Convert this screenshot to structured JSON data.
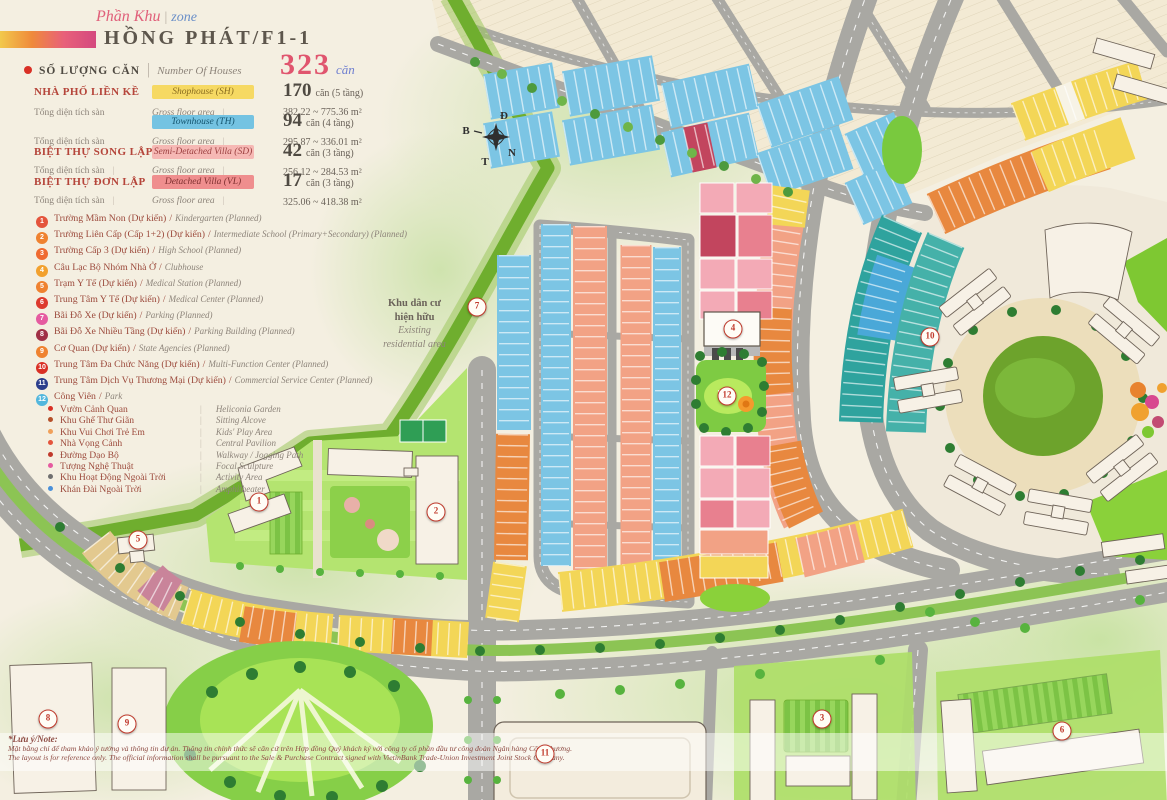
{
  "header": {
    "script_vn": "Phần Khu",
    "script_divider": "|",
    "script_en": "zone",
    "zone_name": "HỒNG PHÁT/F1-1"
  },
  "summary": {
    "label_vn": "SỐ LƯỢNG CĂN",
    "divider": "|",
    "label_en": "Number Of Houses",
    "total": "323",
    "total_unit": "căn"
  },
  "housing_table": {
    "rows": [
      {
        "name_vn": "NHÀ PHỐ LIỀN KỀ",
        "type_en": "Shophouse (SH)",
        "chip_color": "#f6d963",
        "count": "170",
        "count_suffix": "căn (5 tầng)",
        "area": "382.22 ~ 775.36 m²",
        "sub_vn": "Tổng diện tích sàn",
        "sub_en": "Gross floor area"
      },
      {
        "name_vn": "",
        "type_en": "Townhouse (TH)",
        "chip_color": "#74c3e2",
        "count": "94",
        "count_suffix": "căn (4 tầng)",
        "area": "295.87 ~ 336.01 m²",
        "sub_vn": "Tổng diện tích sàn",
        "sub_en": "Gross floor area"
      },
      {
        "name_vn": "BIỆT THỰ SONG LẬP",
        "type_en": "Semi-Detached Villa (SD)",
        "chip_color": "#f6b8b4",
        "count": "42",
        "count_suffix": "căn (3 tầng)",
        "area": "256.12 ~ 284.53 m²",
        "sub_vn": "Tổng diện tích sàn",
        "sub_en": "Gross floor area"
      },
      {
        "name_vn": "BIỆT THỰ ĐƠN LẬP",
        "type_en": "Detached Villa (VL)",
        "chip_color": "#ef8e8e",
        "count": "17",
        "count_suffix": "căn (3 tầng)",
        "area": "325.06 ~ 418.38 m²",
        "sub_vn": "Tổng diện tích sàn",
        "sub_en": "Gross floor area"
      }
    ]
  },
  "facilities": [
    {
      "num": "1",
      "vn": "Trường Mầm Non (Dự kiến)",
      "en": "Kindergarten (Planned)",
      "color": "#e4543c"
    },
    {
      "num": "2",
      "vn": "Trường Liên Cấp (Cấp 1+2) (Dự kiến)",
      "en": "Intermediate School (Primary+Secondary) (Planned)",
      "color": "#ef8230"
    },
    {
      "num": "3",
      "vn": "Trường Cấp 3 (Dự kiến)",
      "en": "High School (Planned)",
      "color": "#ef6a30"
    },
    {
      "num": "4",
      "vn": "Câu Lạc Bộ Nhóm Nhà Ở",
      "en": "Clubhouse",
      "color": "#f2a12e"
    },
    {
      "num": "5",
      "vn": "Trạm Y Tế (Dự kiến)",
      "en": "Medical Station (Planned)",
      "color": "#ef8230"
    },
    {
      "num": "6",
      "vn": "Trung Tâm Y Tế (Dự kiến)",
      "en": "Medical Center (Planned)",
      "color": "#dd3a2e"
    },
    {
      "num": "7",
      "vn": "Bãi Đỗ Xe (Dự kiến)",
      "en": "Parking (Planned)",
      "color": "#e55ba0"
    },
    {
      "num": "8",
      "vn": "Bãi Đỗ Xe Nhiều Tầng (Dự kiến)",
      "en": "Parking Building (Planned)",
      "color": "#a03046"
    },
    {
      "num": "9",
      "vn": "Cơ Quan (Dự kiến)",
      "en": "State Agencies (Planned)",
      "color": "#ef8230"
    },
    {
      "num": "10",
      "vn": "Trung Tâm Đa Chức Năng (Dự kiến)",
      "en": "Multi-Function Center (Planned)",
      "color": "#d93025"
    },
    {
      "num": "11",
      "vn": "Trung Tâm Dịch Vụ Thương Mại (Dự kiến)",
      "en": "Commercial Service Center (Planned)",
      "color": "#2c3e8c"
    },
    {
      "num": "12",
      "vn": "Công Viên",
      "en": "Park",
      "color": "#53b7dd"
    }
  ],
  "park_features": [
    {
      "vn": "Vườn Cảnh Quan",
      "en": "Heliconia Garden",
      "color": "#d93025"
    },
    {
      "vn": "Khu Ghế Thư Giãn",
      "en": "Sitting Alcove",
      "color": "#b5502a"
    },
    {
      "vn": "Khu Vui Chơi Trẻ Em",
      "en": "Kids' Play Area",
      "color": "#f0a05a"
    },
    {
      "vn": "Nhà Vọng Cảnh",
      "en": "Central Pavilion",
      "color": "#e4543c"
    },
    {
      "vn": "Đường Dạo Bộ",
      "en": "Walkway / Jogging Path",
      "color": "#c0392b"
    },
    {
      "vn": "Tượng Nghệ Thuật",
      "en": "Focal Sculpture",
      "color": "#e55ba0"
    },
    {
      "vn": "Khu Hoạt Động Ngoài Trời",
      "en": "Activity Area",
      "color": "#6f6f6f"
    },
    {
      "vn": "Khán Đài Ngoài Trời",
      "en": "Amphitheater",
      "color": "#4a90d9"
    }
  ],
  "map": {
    "compass": {
      "top": "Đ",
      "left": "B",
      "right": "N",
      "bottom": "T"
    },
    "area_label": {
      "vn1": "Khu dân cư",
      "vn2": "hiện hữu",
      "en1": "Existing",
      "en2": "residential area"
    },
    "markers": [
      {
        "n": "1",
        "x": 259,
        "y": 502
      },
      {
        "n": "2",
        "x": 436,
        "y": 512
      },
      {
        "n": "3",
        "x": 822,
        "y": 719
      },
      {
        "n": "4",
        "x": 733,
        "y": 329
      },
      {
        "n": "5",
        "x": 138,
        "y": 540
      },
      {
        "n": "6",
        "x": 1062,
        "y": 731
      },
      {
        "n": "7",
        "x": 477,
        "y": 307
      },
      {
        "n": "8",
        "x": 48,
        "y": 719
      },
      {
        "n": "9",
        "x": 127,
        "y": 724
      },
      {
        "n": "10",
        "x": 930,
        "y": 337
      },
      {
        "n": "11",
        "x": 545,
        "y": 754
      },
      {
        "n": "12",
        "x": 727,
        "y": 396
      }
    ]
  },
  "note": {
    "title": "*Lưu ý/Note:",
    "vn": "Mặt bằng chỉ để tham khảo ý tưởng và thông tin dự án. Thông tin chính thức sẽ căn cứ trên Hợp đồng Quý khách ký với công ty cổ phần đầu tư công đoàn Ngân hàng Công thương.",
    "en": "The layout is for reference only. The official information shall be pursuant to the Sale & Purchase Contract signed with VietinBank Trade-Union Investment Joint Stock Company."
  }
}
